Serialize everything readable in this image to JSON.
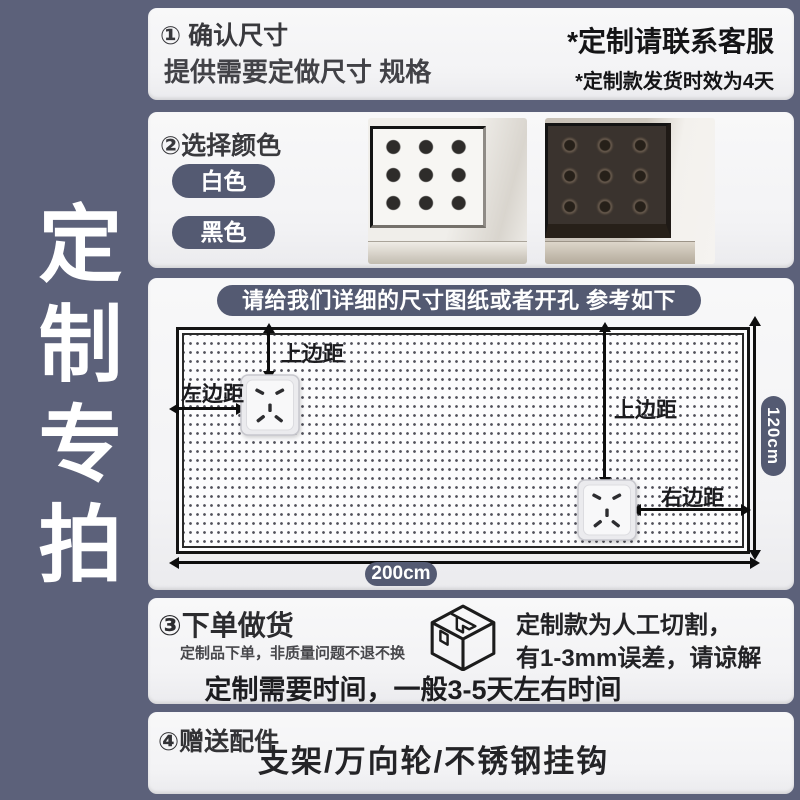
{
  "page": {
    "background_color": "#5c617a",
    "panel_color": "#f5f5f6",
    "accent_color": "#545a72",
    "sidebar_title": "定制专拍"
  },
  "confirm_section": {
    "heading": "① 确认尺寸",
    "subheading": "提供需要定做尺寸 规格",
    "service_note": "*定制请联系客服",
    "delivery_note": "*定制款发货时效为4天"
  },
  "color_section": {
    "heading": "②选择颜色",
    "options": [
      {
        "label": "白色"
      },
      {
        "label": "黑色"
      }
    ]
  },
  "diagram_section": {
    "title": "请给我们详细的尺寸图纸或者开孔 参考如下",
    "top_margin_label": "上边距",
    "left_margin_label": "左边距",
    "right_margin_label": "右边距",
    "board_width_label": "200cm",
    "board_height_label": "120cm"
  },
  "order_section": {
    "heading": "③下单做货",
    "note": "定制品下单，非质量问题不退不换",
    "cutting_line1": "定制款为人工切割，",
    "cutting_line2": "有1-3mm误差，请谅解",
    "time_note": "定制需要时间，一般3-5天左右时间"
  },
  "gift_section": {
    "heading": "④赠送配件",
    "items": "支架/万向轮/不锈钢挂钩"
  }
}
